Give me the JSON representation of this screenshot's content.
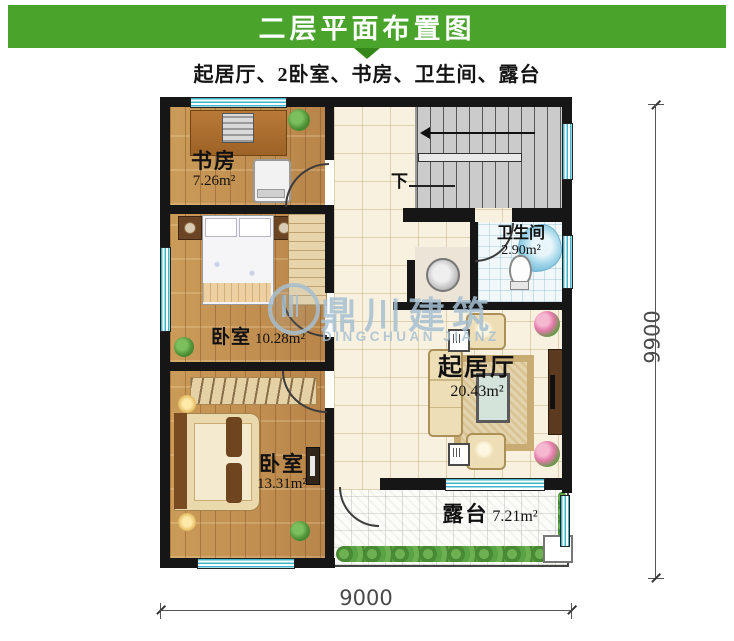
{
  "header": {
    "title": "二层平面布置图",
    "subtitle": "起居厅、2卧室、书房、卫生间、露台",
    "bar_color": "#4aa32b"
  },
  "plan": {
    "rooms": {
      "study": {
        "name": "书房",
        "area": "7.26m²"
      },
      "bedroom_mid": {
        "name": "卧室",
        "area": "10.28m²"
      },
      "bedroom_lower": {
        "name": "卧室",
        "area": "13.31m²"
      },
      "bathroom": {
        "name": "卫生间",
        "area": "2.90m²"
      },
      "living": {
        "name": "起居厅",
        "area": "20.43m²"
      },
      "terrace": {
        "name": "露台",
        "area": "7.21m²"
      }
    },
    "stairs": {
      "down_label": "下"
    },
    "colors": {
      "wall": "#161616",
      "wood_floor": "#c49455",
      "tile_floor": "#f8f1df",
      "stairs": "#cbcbcb",
      "window": "#3fb6cc",
      "greenery": "#5aa344"
    }
  },
  "watermark": {
    "cn": "鼎川建筑",
    "en": "DINGCHUAN JIANZ",
    "color": "#a6c0d2"
  },
  "dimensions": {
    "bottom": "9000",
    "right": "9900"
  }
}
